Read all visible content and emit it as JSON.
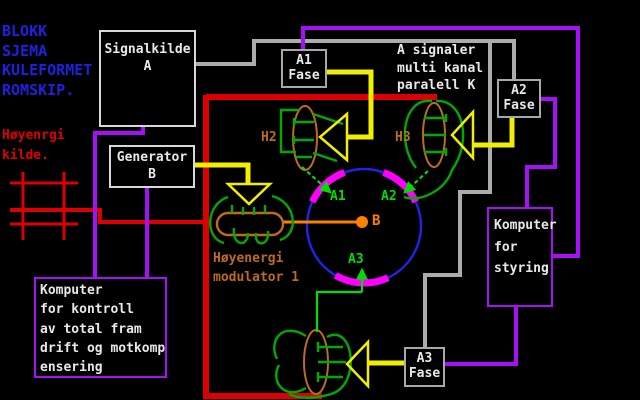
{
  "title": {
    "lines": [
      "BLOKK",
      "SJEMA",
      "KULEFORMET",
      "ROMSKIP."
    ]
  },
  "energy_source": {
    "lines": [
      "Høyenrgi",
      "kilde."
    ]
  },
  "signal_note": {
    "lines": [
      "A signaler",
      "multi kanal",
      "paralell K"
    ]
  },
  "boxes": {
    "signal_source": {
      "line1": "Signalkilde",
      "line2": "A"
    },
    "a1_phase": {
      "line1": "A1",
      "line2": "Fase"
    },
    "a2_phase": {
      "line1": "A2",
      "line2": "Fase"
    },
    "a3_phase": {
      "line1": "A3",
      "line2": "Fase"
    },
    "generator": {
      "line1": "Generator",
      "line2": "B"
    },
    "control_computer": {
      "lines": [
        "Komputer",
        "for kontroll",
        "av total fram",
        "drift og motkomp",
        "ensering"
      ]
    },
    "steering_computer": {
      "lines": [
        "Komputer",
        "for",
        "styring"
      ]
    }
  },
  "antennas": {
    "h2": "H2",
    "h3": "H3"
  },
  "modulator": {
    "lines": [
      "Høyenergi",
      "modulator 1"
    ]
  },
  "nodes": {
    "a1": "A1",
    "a2": "A2",
    "b": "B",
    "a3": "A3"
  },
  "colors": {
    "background": "#000000",
    "red": "#DC0000",
    "title_blue": "#2020E0",
    "circle_blue": "#2222E8",
    "purple": "#A510F5",
    "yellow": "#F2EE00",
    "coil_green": "#00AA00",
    "bright_green": "#00DD00",
    "magenta": "#FF00FF",
    "orange": "#FF7F00",
    "brown": "#BE6A20",
    "gray": "#ACACAC",
    "white": "#E8E8E8"
  }
}
